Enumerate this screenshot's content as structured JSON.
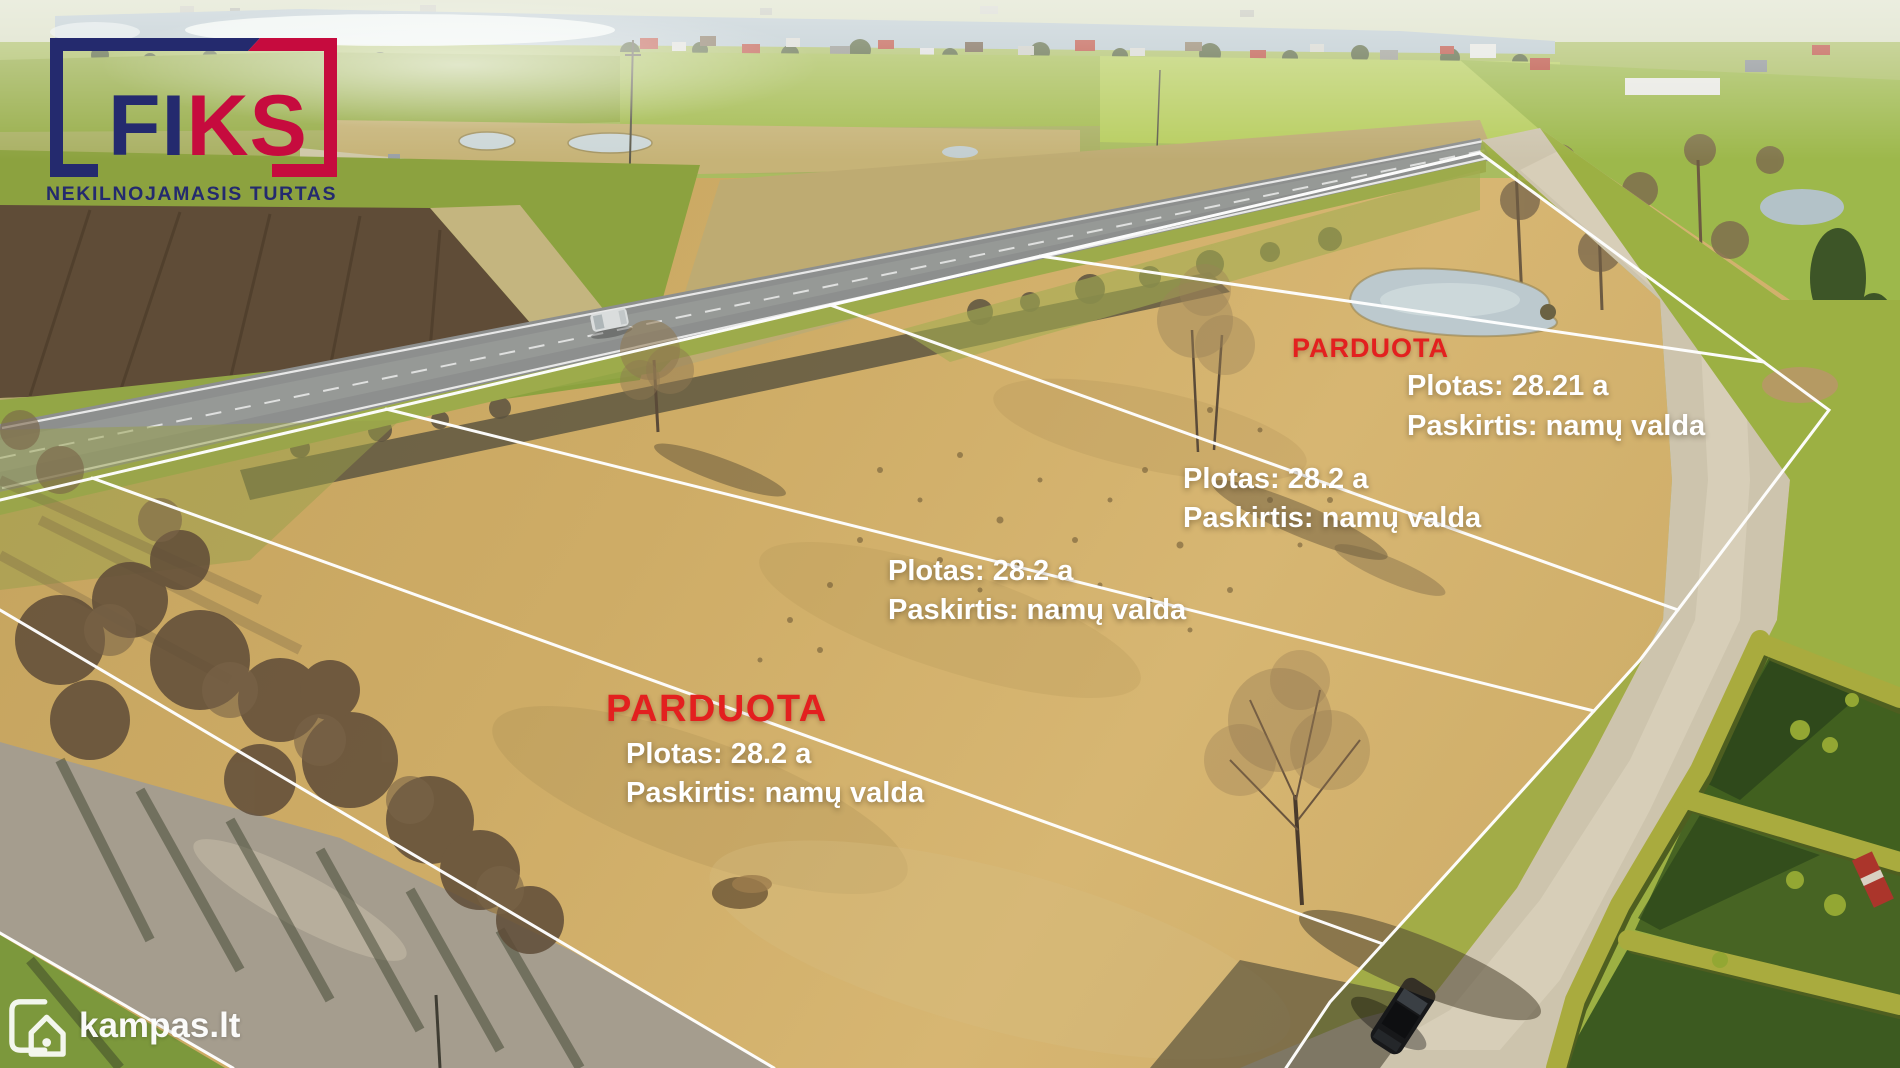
{
  "logo": {
    "brand_left": "FI",
    "brand_right": "KS",
    "tagline": "NEKILNOJAMASIS TURTAS",
    "color_navy": "#242a6e",
    "color_crimson": "#c60b3e"
  },
  "plots": [
    {
      "status": "PARDUOTA",
      "area": "Plotas: 28.21 a",
      "purpose": "Paskirtis: namų valda"
    },
    {
      "status": "",
      "area": "Plotas: 28.2 a",
      "purpose": "Paskirtis: namų valda"
    },
    {
      "status": "",
      "area": "Plotas: 28.2 a",
      "purpose": "Paskirtis: namų valda"
    },
    {
      "status": "PARDUOTA",
      "area": "Plotas: 28.2 a",
      "purpose": "Paskirtis: namų valda"
    }
  ],
  "watermark": {
    "site": "kampas.lt"
  },
  "colors": {
    "sold_red": "#e3201f",
    "overlay_white": "#ffffff",
    "boundary_line": "#ffffff"
  }
}
